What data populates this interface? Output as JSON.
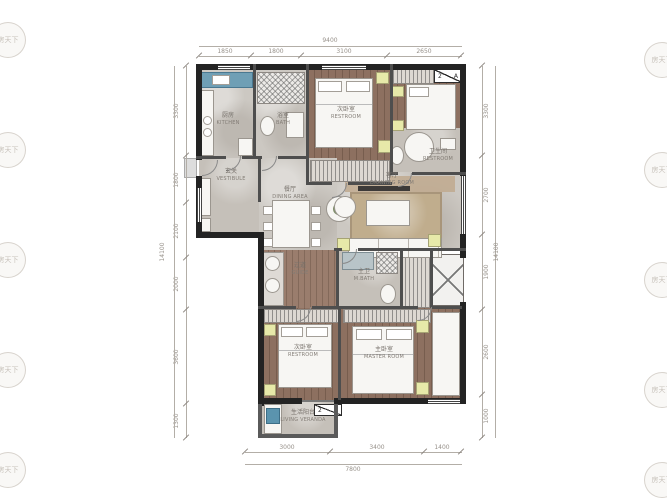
{
  "watermark": {
    "text": "房天下"
  },
  "colors": {
    "wall": "#232323",
    "wood_floor": "#8d7060",
    "tile_floor": "#ccc8c2",
    "accent_yellow": "#e7e9a9",
    "accent_blue": "#5b94ae",
    "rug_tan": "#c0ad8d"
  },
  "rooms": {
    "kitchen": {
      "zh": "厨房",
      "en": "KITCHEN"
    },
    "bath": {
      "zh": "浴室",
      "en": "BATH"
    },
    "bedroom_top": {
      "zh": "次卧室",
      "en": "RESTROOM"
    },
    "bathroom_top": {
      "zh": "卫生间",
      "en": "RESTROOM"
    },
    "vestibule": {
      "zh": "玄关",
      "en": "VESTIBULE"
    },
    "dining": {
      "zh": "餐厅",
      "en": "DINING AREA"
    },
    "living": {
      "zh": "客厅",
      "en": "DRAWING ROOM"
    },
    "corridor": {
      "zh": "过道",
      "en": "GUIDE"
    },
    "master_bath": {
      "zh": "主卫",
      "en": "M.BATH"
    },
    "bedroom_bottom": {
      "zh": "次卧室",
      "en": "RESTROOM"
    },
    "master_bedroom": {
      "zh": "主卧室",
      "en": "MASTER ROOM"
    },
    "veranda": {
      "zh": "生活阳台",
      "en": "LIVING VERANDA"
    }
  },
  "section_marker": {
    "num": "2",
    "letter": "A"
  },
  "dimensions": {
    "top": {
      "total": "9400",
      "segments": [
        "1850",
        "1800",
        "3100",
        "2650"
      ]
    },
    "bottom": {
      "total": "7800",
      "segments": [
        "3000",
        "3400",
        "1400"
      ]
    },
    "left": {
      "total": "14100",
      "segments": [
        "3300",
        "1800",
        "2100",
        "2000",
        "3600",
        "1300"
      ]
    },
    "right": {
      "total": "14100",
      "segments": [
        "3300",
        "2700",
        "1900",
        "2600",
        "1000"
      ]
    }
  }
}
